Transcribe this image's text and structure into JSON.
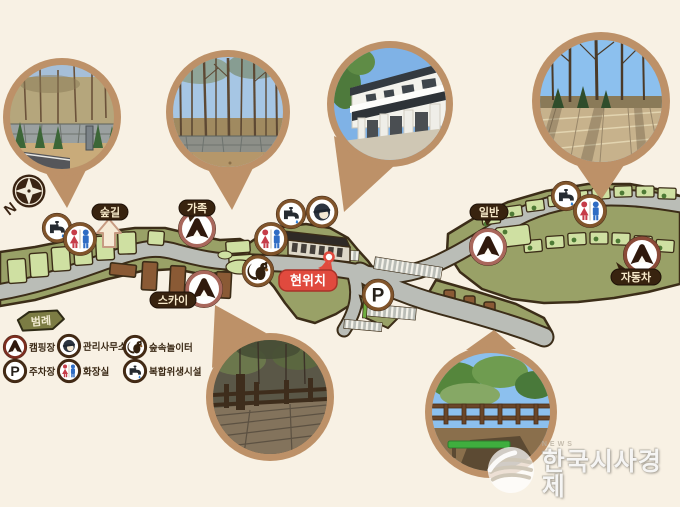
{
  "compass": {
    "label": "N"
  },
  "labels": {
    "forest_trail": "숲길",
    "family": "가족",
    "sky": "스카이",
    "general": "일반",
    "car": "자동차",
    "current_location": "현위치"
  },
  "legend": {
    "title": "범례",
    "items": [
      {
        "icon": "tent-icon",
        "label": "캠핑장"
      },
      {
        "icon": "office-manager-icon",
        "label": "관리사무소"
      },
      {
        "icon": "squirrel-icon",
        "label": "숲속놀이터"
      },
      {
        "icon": "parking-icon",
        "label": "주차장"
      },
      {
        "icon": "restroom-icon",
        "label": "화장실"
      },
      {
        "icon": "faucet-icon",
        "label": "복합위생시설"
      }
    ]
  },
  "badges": {
    "parking_letter": "P"
  },
  "watermark": {
    "tagline": "NEWS",
    "name": "한국시사경제"
  },
  "colors": {
    "background": "#f8f1e4",
    "terrain": "#99a167",
    "campsite_pad": "#cfe0a2",
    "road": "#babdb7",
    "outline": "#3c2d18",
    "photo_border": "#bd9168",
    "label_bg": "#38230f",
    "label_text": "#f7e9c9",
    "current_location_red": "#e04a3e",
    "tent_ring": "#a9675c",
    "facility_ring": "#80542b",
    "deck_brown": "#8a5a35"
  }
}
